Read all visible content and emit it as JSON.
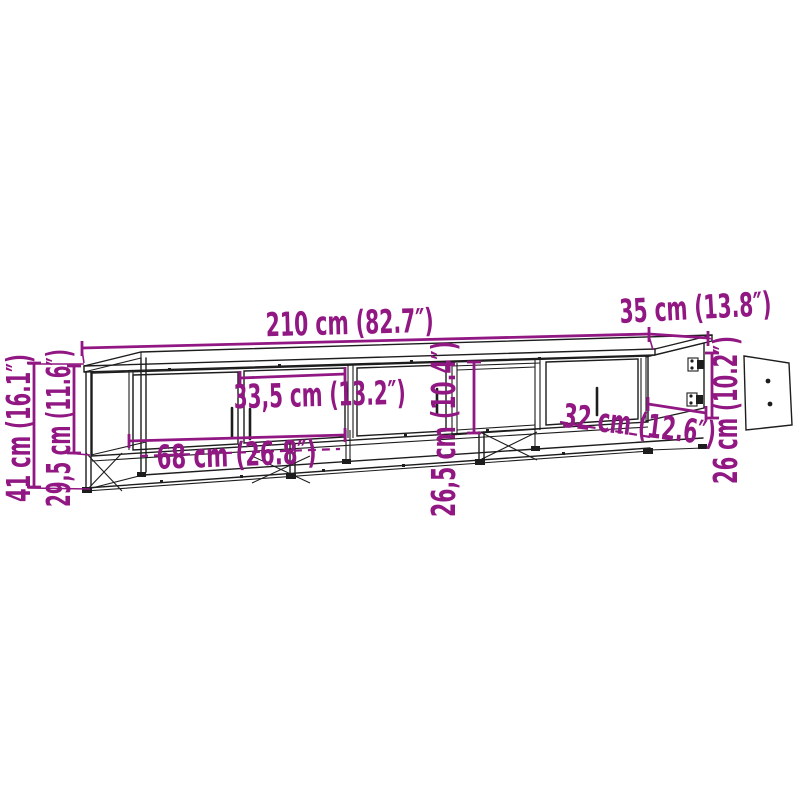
{
  "figure": {
    "kind": "product dimension diagram",
    "subject": "TV cabinet with metal frame, open shelf and detached door panel",
    "background_color": "#ffffff",
    "line_color": "#1d1d1d",
    "accent_color": "#911783"
  },
  "dimensions": {
    "overall_width": {
      "label": "210 cm (82.7″)",
      "cm": "210",
      "inch": "82.7"
    },
    "depth": {
      "label": "35 cm (13.8″)",
      "cm": "35",
      "inch": "13.8"
    },
    "overall_height": {
      "label": "41 cm (16.1″)",
      "cm": "41",
      "inch": "16.1"
    },
    "cabinet_height": {
      "label": "29,5 cm (11.6″)",
      "cm": "29,5",
      "inch": "11.6"
    },
    "door_width": {
      "label": "33,5 cm (13.2″)",
      "cm": "33,5",
      "inch": "13.2"
    },
    "compartment_width": {
      "label": "68 cm (26.8″)",
      "cm": "68",
      "inch": "26.8"
    },
    "inner_height_mid": {
      "label": "26,5 cm (10.4″)",
      "cm": "26,5",
      "inch": "10.4"
    },
    "open_section_width": {
      "label": "32 cm (12.6″)",
      "cm": "32",
      "inch": "12.6"
    },
    "inner_height_right": {
      "label": "26 cm (10.2″)",
      "cm": "26",
      "inch": "10.2"
    }
  }
}
